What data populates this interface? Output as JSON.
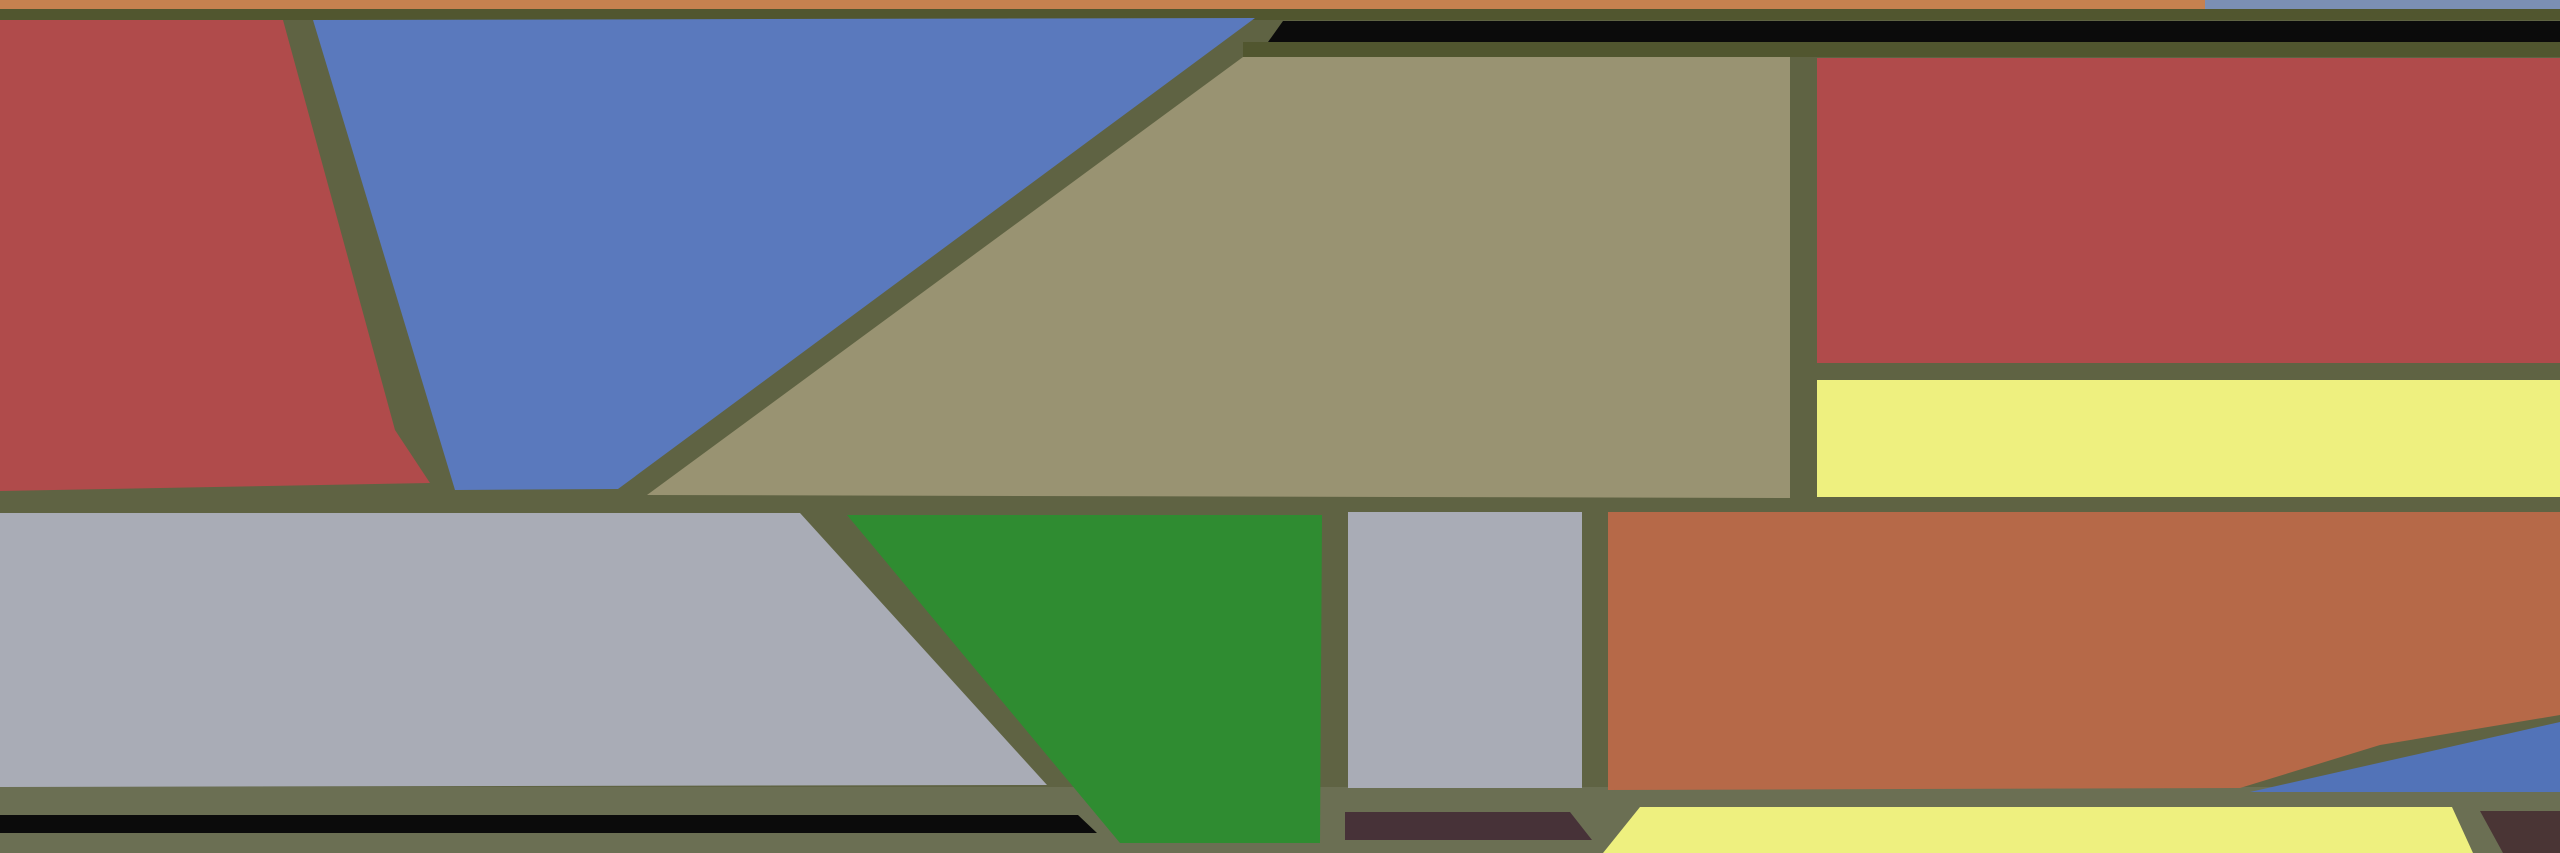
{
  "artwork": {
    "description": "abstract-polygon-stained-glass-composition",
    "canvas": {
      "width": 2560,
      "height": 853
    },
    "palette": {
      "background_olive": "#5f6343",
      "bottom_band_olive": "#6b6f53",
      "dark_border_olive": "#51562f",
      "red": "#b04b4b",
      "blue": "#5a79bd",
      "muted_blue": "#7b8fb4",
      "deep_blue": "#5273b8",
      "khaki": "#999372",
      "gray": "#a9acb6",
      "green": "#2f8c31",
      "terracotta": "#b66948",
      "top_orange": "#c6814f",
      "yellow": "#eef07f",
      "black": "#0b0b0b",
      "maroon": "#473238",
      "dark_maroon_corner": "#4a3535"
    },
    "shapes": [
      {
        "name": "bottom-olive-band",
        "color": "#6b6f53",
        "points": "0,787 2560,787 2560,853 0,853"
      },
      {
        "name": "top-border-dark-band",
        "color": "#51562f",
        "points": "0,8 2560,8 2560,20 0,20"
      },
      {
        "name": "black-strip-shadow-band",
        "color": "#51562f",
        "points": "1243,42 2560,42 2560,57 1243,57"
      },
      {
        "name": "top-strip-orange",
        "color": "#c6814f",
        "points": "0,0 2205,0 2205,9 0,9"
      },
      {
        "name": "top-strip-muted-blue",
        "color": "#7b8fb4",
        "points": "2205,0 2560,0 2560,9 2205,9"
      },
      {
        "name": "black-top-strip",
        "color": "#0b0b0b",
        "points": "1283,21 2560,21 2560,42 1268,42"
      },
      {
        "name": "red-top-left-quad",
        "color": "#b04b4b",
        "points": "0,20 283,20 395,430 430,483 0,491"
      },
      {
        "name": "blue-top-wedge",
        "color": "#5a79bd",
        "points": "313,20 1255,18 618,489 455,490"
      },
      {
        "name": "khaki-large-panel",
        "color": "#999372",
        "points": "1243,57 1790,57 1790,498 647,495"
      },
      {
        "name": "red-top-right-panel",
        "color": "#b04b4b",
        "points": "1817,58 2560,58 2560,363 1817,363"
      },
      {
        "name": "yellow-right-strip",
        "color": "#eef07f",
        "points": "1817,380 2560,380 2560,497 1817,497"
      },
      {
        "name": "gray-left-band",
        "color": "#a9acb6",
        "points": "0,513 800,513 1047,785 0,787"
      },
      {
        "name": "green-trapezoid",
        "color": "#2f8c31",
        "points": "847,515 1322,515 1320,843 1120,843"
      },
      {
        "name": "gray-middle-panel",
        "color": "#a9acb6",
        "points": "1348,512 1582,512 1582,788 1348,788"
      },
      {
        "name": "terracotta-panel",
        "color": "#b66948",
        "points": "1608,512 2560,512 2560,715 2380,745 2240,788 1608,790"
      },
      {
        "name": "blue-bottom-wedge",
        "color": "#5273b8",
        "points": "2250,792 2560,722 2560,792"
      },
      {
        "name": "black-bottom-strip",
        "color": "#0b0b0b",
        "points": "0,815 1078,815 1097,833 0,833"
      },
      {
        "name": "maroon-bottom-strip",
        "color": "#473238",
        "points": "1345,812 1570,812 1592,840 1345,840"
      },
      {
        "name": "yellow-bottom-strip",
        "color": "#eef07f",
        "points": "1640,807 2452,807 2473,853 1603,853"
      },
      {
        "name": "maroon-corner-quad",
        "color": "#4a3535",
        "points": "2480,811 2560,811 2560,853 2503,853"
      }
    ]
  }
}
